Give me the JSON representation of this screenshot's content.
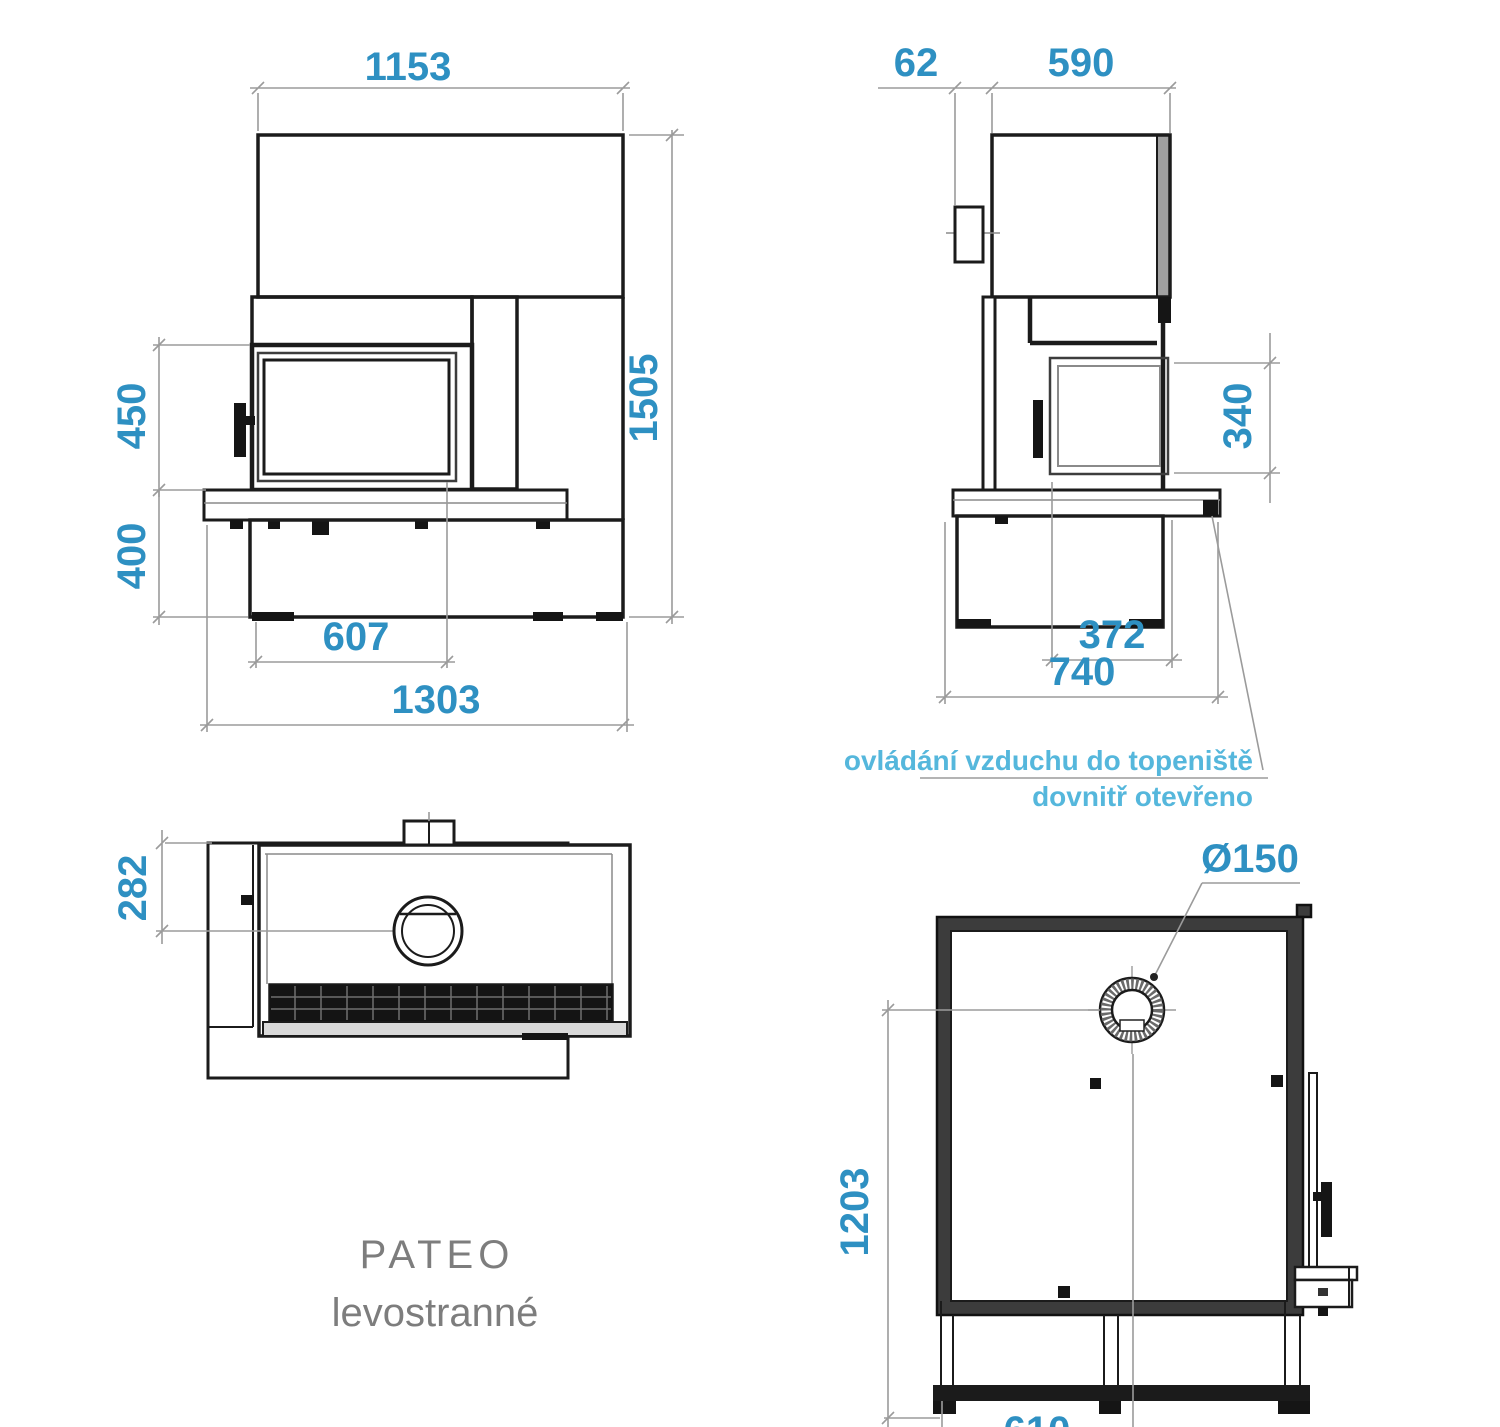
{
  "title": {
    "model": "PATEO",
    "variant": "levostranné"
  },
  "annotation": {
    "line1": "ovládání vzduchu do topeniště",
    "line2": "dovnitř otevřeno"
  },
  "dims": {
    "front_hood_width": "1153",
    "front_total_height": "1505",
    "front_door_height": "450",
    "front_plinth_height": "400",
    "front_firebox_width": "607",
    "front_base_width": "1303",
    "side_handle_offset": "62",
    "side_body_depth": "590",
    "side_glass_height": "340",
    "side_glass_width": "372",
    "side_bench_depth": "740",
    "top_flue_offset": "282",
    "plan_flue_diameter": "Ø150",
    "plan_flue_to_front": "1203",
    "plan_half_width": "610"
  },
  "colors": {
    "dimension_text": "#2e90c2",
    "annotation_text": "#55b7dc",
    "title_text": "#7d7d7d",
    "drawing_line": "#1b1b1b",
    "dimension_line": "#9b9b9b"
  }
}
